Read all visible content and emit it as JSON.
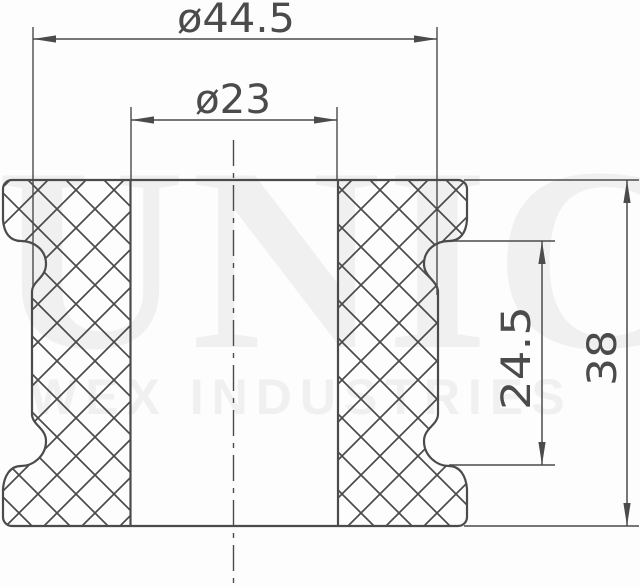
{
  "drawing": {
    "type": "technical cross-section drawing of a rubber bushing with grooved waist and through bore",
    "units": "mm",
    "dimensions": {
      "outer_groove_diameter": {
        "label": "ø44.5",
        "value": 44.5
      },
      "bore_diameter": {
        "label": "ø23",
        "value": 23
      },
      "groove_height": {
        "label": "24.5",
        "value": 24.5
      },
      "overall_height": {
        "label": "38",
        "value": 38
      }
    },
    "features": [
      "crosshatched section walls",
      "dash-dot vertical centerline",
      "outward-pointing dimension arrows"
    ]
  },
  "watermark": {
    "brand": "UNIC",
    "subtitle": "WEX INDUSTRIES"
  },
  "colors": {
    "line": "#4b4b4b",
    "watermark": "#f0f0f0",
    "background": "#fdfdfd"
  }
}
